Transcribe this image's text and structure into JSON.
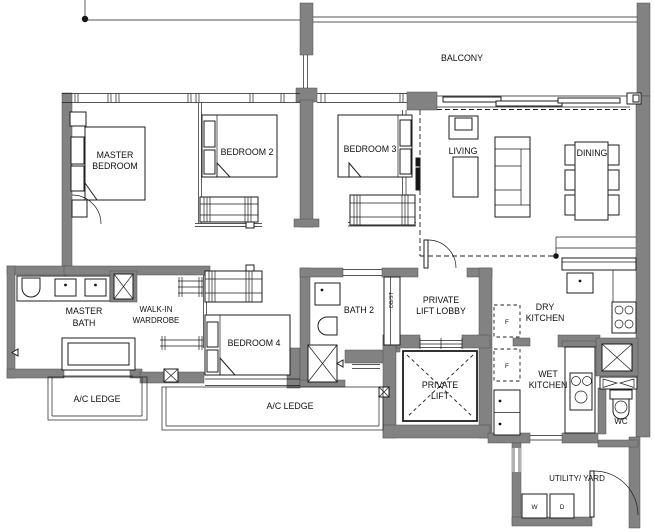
{
  "plan": {
    "balcony": {
      "label": "BALCONY"
    },
    "master_bedroom": {
      "l1": "MASTER",
      "l2": "BEDROOM"
    },
    "bedroom2": {
      "label": "BEDROOM 2"
    },
    "bedroom3": {
      "label": "BEDROOM 3"
    },
    "bedroom4": {
      "label": "BEDROOM 4"
    },
    "living": {
      "label": "LIVING"
    },
    "dining": {
      "label": "DINING"
    },
    "master_bath": {
      "l1": "MASTER",
      "l2": "BATH"
    },
    "walk_in_wardrobe": {
      "l1": "WALK-IN",
      "l2": "WARDROBE"
    },
    "bath2": {
      "label": "BATH 2"
    },
    "private_lift_lobby": {
      "l1": "PRIVATE",
      "l2": "LIFT LOBBY"
    },
    "private_lift": {
      "l1": "PRIVATE",
      "l2": "LIFT"
    },
    "dry_kitchen": {
      "l1": "DRY",
      "l2": "KITCHEN"
    },
    "wet_kitchen": {
      "l1": "WET",
      "l2": "KITCHEN"
    },
    "wc": {
      "label": "WC"
    },
    "ac_ledge_left": {
      "label": "A/C LEDGE"
    },
    "ac_ledge_center": {
      "label": "A/C LEDGE"
    },
    "utility_yard": {
      "label": "UTILITY/ YARD"
    },
    "washer": {
      "label": "W"
    },
    "dryer": {
      "label": "D"
    },
    "fridge_upper": {
      "label": "F"
    },
    "fridge_lower": {
      "label": "F"
    },
    "db_st": {
      "label": "DB/ST"
    }
  },
  "colors": {
    "wall": "#828282",
    "line": "#1c1c1c",
    "background": "#ffffff"
  }
}
